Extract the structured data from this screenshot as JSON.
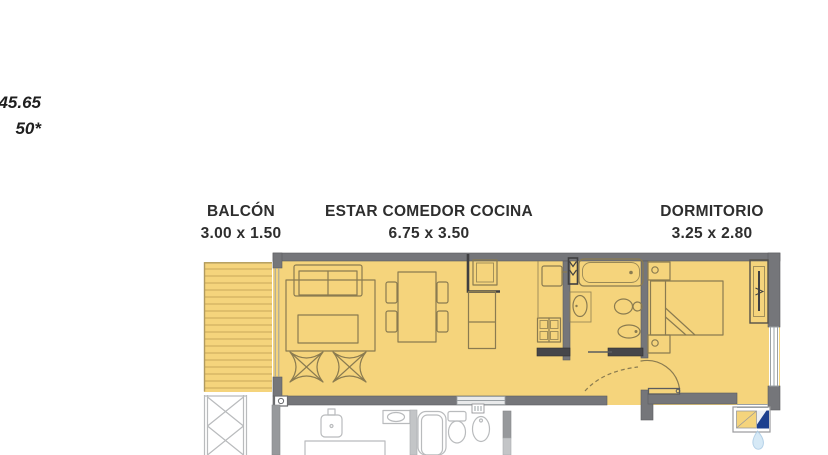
{
  "annotation": {
    "line1": "45.65",
    "line2": "50*"
  },
  "labels": {
    "balcony": {
      "name": "BALCÓN",
      "dims": "3.00 x 1.50"
    },
    "living": {
      "name": "ESTAR COMEDOR COCINA",
      "dims": "6.75 x 3.50"
    },
    "bedroom": {
      "name": "DORMITORIO",
      "dims": "3.25 x 2.80"
    }
  },
  "colors": {
    "floor": "#F5D47C",
    "deck_line": "#C9A75A",
    "wall": "#75767A",
    "wall_dark": "#46464A",
    "furniture_line": "#8A7B50",
    "neighbor_line": "#B9BBBD",
    "text": "#2E2E2E",
    "logo_blue": "#1C3F8E",
    "logo_light_blue": "#CFE6F5"
  },
  "plan": {
    "type": "apartment-floor-plan",
    "highlighted_rooms": [
      "BALCÓN",
      "ESTAR COMEDOR COCINA",
      "DORMITORIO"
    ],
    "symbols": [
      "balcony-deck",
      "sofa",
      "rug",
      "coffee-table",
      "butterfly-chair",
      "dining-table",
      "dining-chair",
      "kitchen-sink",
      "kitchen-counter",
      "fridge",
      "stove",
      "water-heater-closet",
      "bathtub",
      "washbasin",
      "toilet",
      "bidet",
      "door-swing",
      "bed",
      "nightstand",
      "wardrobe",
      "window",
      "neighbor-bathroom-fixtures",
      "water-drop-logo"
    ]
  }
}
